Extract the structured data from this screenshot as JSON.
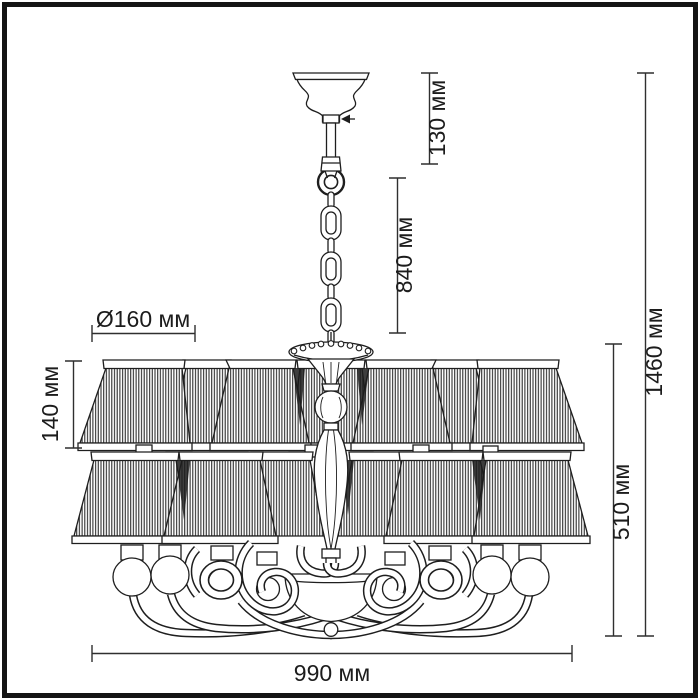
{
  "diagram": {
    "title": "Chandelier dimensional line drawing",
    "unit": "мм",
    "dimensions": {
      "canopy_height": "130 мм",
      "chain_drop": "840 мм",
      "overall_height": "1460 мм",
      "fixture_height": "510 мм",
      "shade_height": "140 мм",
      "shade_diameter": "Ø160 мм",
      "overall_width": "990 мм"
    },
    "style": {
      "line_color": "#1e1e1e",
      "dimension_color": "#2f2f2f",
      "background": "#ffffff"
    }
  }
}
